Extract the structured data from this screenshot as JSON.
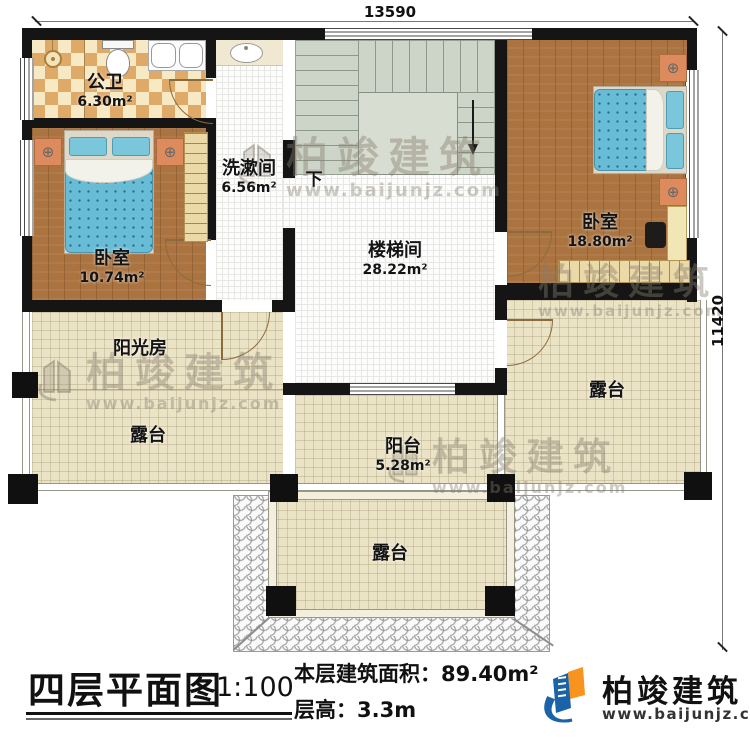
{
  "dimensions": {
    "top": "13590",
    "right": "11420"
  },
  "rooms": {
    "bathroom": {
      "name": "公卫",
      "area": "6.30m²"
    },
    "washroom": {
      "name": "洗漱间",
      "area": "6.56m²"
    },
    "bedroom_left": {
      "name": "卧室",
      "area": "10.74m²"
    },
    "bedroom_right": {
      "name": "卧室",
      "area": "18.80m²"
    },
    "stair_hall": {
      "name": "楼梯间",
      "area": "28.22m²"
    },
    "sunroom": {
      "name": "阳光房"
    },
    "balcony": {
      "name": "阳台",
      "area": "5.28m²"
    },
    "terrace_left": {
      "name": "露台"
    },
    "terrace_right": {
      "name": "露台"
    },
    "terrace_bottom": {
      "name": "露台"
    },
    "stairs_down": "下"
  },
  "titleblock": {
    "title": "四层平面图",
    "scale": "1:100",
    "area_text": "本层建筑面积：89.40m²",
    "height_text": "层高：3.3m"
  },
  "brand": {
    "name": "柏竣建筑",
    "url": "www.baijunjz.com"
  },
  "watermark": {
    "name": "柏竣建筑",
    "url": "www.baijunjz.com"
  },
  "colors": {
    "brand_blue": "#1a63a8",
    "brand_orange": "#f7941d",
    "wall": "#151515",
    "wood": "#aa7340",
    "tile_cream": "#ebe3c6",
    "stair_sage": "#cdd5c8"
  }
}
